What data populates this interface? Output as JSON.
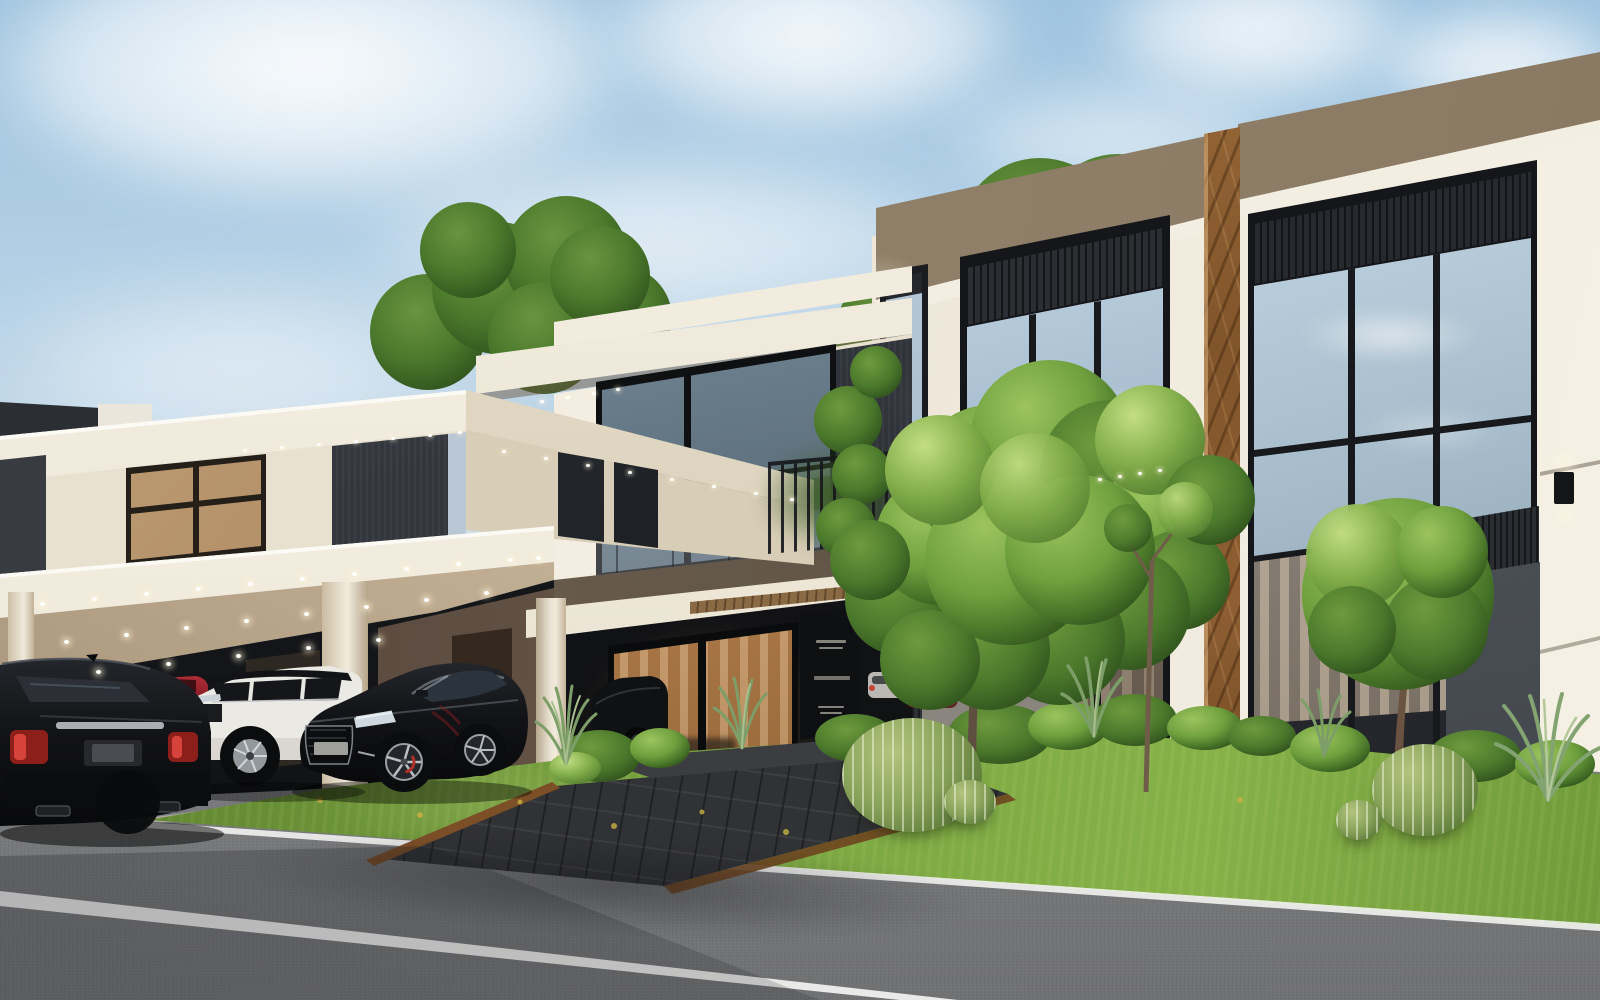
{
  "meta": {
    "title": "Photorealistic exterior rendering of a modern luxury villa complex at dusk/daytime",
    "image_type": "architectural-visualization",
    "dimensions": {
      "width": 1600,
      "height": 1000
    }
  },
  "palette": {
    "sky_top": "#9fc4e0",
    "cloud": "#f5f7f7",
    "cream": "#e9e1d0",
    "cream_bright": "#f6f1e6",
    "cream_shade": "#d8cdb7",
    "fascia_white": "#f4efe3",
    "dark_panel": "#33373c",
    "charcoal": "#17191c",
    "grey_stone": "#565b61",
    "brown_stone": "#94836c",
    "marble": "#8a5c31",
    "glass_sky": "#b6cbdb",
    "glass_dark": "#3e4d58",
    "mullion": "#17191d",
    "warm": "#c08c55",
    "curtain": "#d9b88f",
    "wood": "#8a6a44",
    "grass": "#7da943",
    "grass_dark": "#55772c",
    "bush": "#3c6124",
    "tree": "#69a13c",
    "tree_dark": "#3e6b22",
    "cactus": "#8aa45c",
    "road": "#8a8b8d",
    "line": "#e9e9e7",
    "corten": "#7d4f27",
    "car_black": "#0c0d0f",
    "car_white": "#eceae5",
    "car_red": "#9c2430",
    "taillight": "#c0392b",
    "rim": "#a6abb0"
  },
  "scene": {
    "sky": {
      "label": "Blue daytime sky with scattered white clouds",
      "cloud_count": 7
    },
    "buildings": [
      {
        "id": "left-villa",
        "label": "Left two-storey villa with cantilevered carport canopy and recessed downlights"
      },
      {
        "id": "middle-villa",
        "label": "Middle villa with glass balcony, dark stone cladding and warm-lit entrance doors"
      },
      {
        "id": "right-villa",
        "label": "Right villa with brown stone parapet, brown marble pilaster and full-height glazing reflecting the sky"
      }
    ],
    "signage": {
      "label": "Dark entrance sign panel with fine etched lettering (not legible)",
      "legible": false,
      "text_line_count": 5
    },
    "vehicles": [
      {
        "id": "black-luxury-sedan",
        "label": "Black luxury sedan seen from rear on the road"
      },
      {
        "id": "white-suv",
        "label": "White luxury SUV parked under the carport"
      },
      {
        "id": "red-sports-car",
        "label": "Red sports car partially visible behind parked cars"
      },
      {
        "id": "black-coupe",
        "label": "Black coupe with silver wheels parked on the lawn pavers"
      },
      {
        "id": "carport-parked-cars",
        "label": "Additional cars glimpsed in the middle villa carport"
      }
    ],
    "landscape": {
      "lawn": "Sunlit green lawn strip between villas and road",
      "walkway": "Dark paver entrance walkway with corten steel edging",
      "center_tree": "Tall deciduous tree with bright green canopy in front of the right villa",
      "slender_tree": "Slender young tree beside the main tree",
      "topiary_tree": "Round clipped topiary tree in front of grey stone wall",
      "background_trees": "Background tree canopies rising behind both villas",
      "cacti": "Four golden barrel cacti on the lawn",
      "shrubs": "Row of clipped shrub balls along the building base",
      "grasses": "Ornamental spiky grasses scattered along the bed"
    },
    "road": {
      "surface": "Grey asphalt road in foreground",
      "markings": [
        "thin white edge line along the lawn",
        "wide white lane line across the foreground"
      ]
    },
    "lighting": {
      "sets": [
        {
          "container": "dl-carport",
          "size": "big",
          "points": [
            [
              40,
              602
            ],
            [
              92,
              597
            ],
            [
              144,
              592
            ],
            [
              196,
              587
            ],
            [
              248,
              582
            ],
            [
              300,
              577
            ],
            [
              352,
              572
            ],
            [
              404,
              567
            ],
            [
              456,
              562
            ],
            [
              508,
              558
            ],
            [
              536,
              556
            ],
            [
              64,
              640
            ],
            [
              124,
              633
            ],
            [
              184,
              626
            ],
            [
              244,
              619
            ],
            [
              304,
              612
            ],
            [
              364,
              605
            ],
            [
              424,
              598
            ],
            [
              484,
              591
            ],
            [
              96,
              670
            ],
            [
              166,
              662
            ],
            [
              236,
              654
            ],
            [
              306,
              646
            ],
            [
              376,
              638
            ]
          ]
        },
        {
          "container": "dl-front",
          "size": "small",
          "points": [
            [
              243,
              449
            ],
            [
              280,
              446
            ],
            [
              317,
              443
            ],
            [
              354,
              440
            ],
            [
              391,
              437
            ],
            [
              428,
              434
            ],
            [
              458,
              431
            ]
          ]
        },
        {
          "container": "dl-wing",
          "size": "small",
          "points": [
            [
              502,
              450
            ],
            [
              544,
              457
            ],
            [
              586,
              464
            ],
            [
              628,
              471
            ],
            [
              670,
              478
            ],
            [
              712,
              485
            ],
            [
              754,
              492
            ],
            [
              790,
              498
            ]
          ]
        },
        {
          "container": "dl-villa",
          "size": "small",
          "points": [
            [
              540,
              400
            ],
            [
              566,
              396
            ],
            [
              592,
              392
            ],
            [
              616,
              388
            ]
          ]
        },
        {
          "container": "dl-right",
          "size": "small",
          "points": [
            [
              1098,
              478
            ],
            [
              1118,
              475
            ],
            [
              1138,
              472
            ],
            [
              1158,
              469
            ]
          ]
        }
      ]
    }
  }
}
